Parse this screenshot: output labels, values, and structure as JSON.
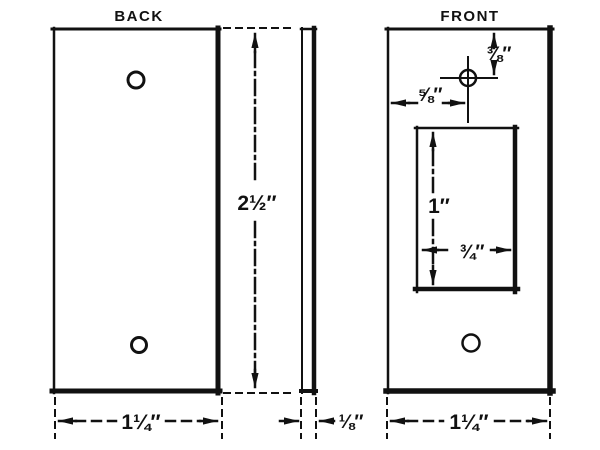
{
  "page": {
    "background": "#ffffff",
    "ink": "#111111"
  },
  "views": {
    "back": {
      "title": "BACK",
      "height_label": "2½″",
      "width_label": "1¼″"
    },
    "side": {
      "thickness_label": "⅛″"
    },
    "front": {
      "title": "FRONT",
      "hole_top_offset_label": "⅜″",
      "hole_left_offset_label": "⅝″",
      "cutout_height_label": "1″",
      "cutout_width_label": "¾″",
      "width_label": "1¼″"
    }
  }
}
